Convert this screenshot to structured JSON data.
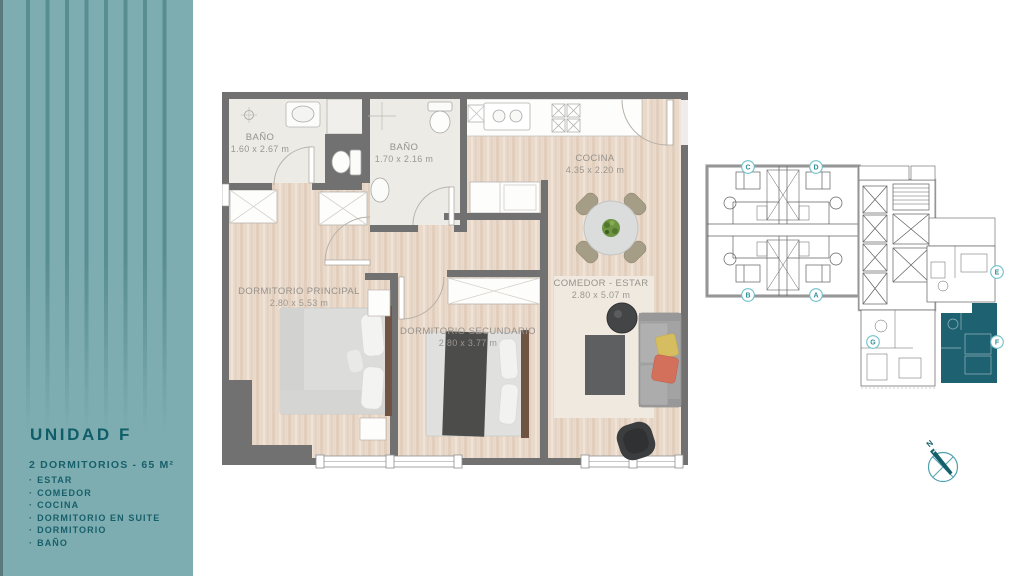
{
  "sidebar": {
    "title": "UNIDAD F",
    "subtitle": "2 DORMITORIOS - 65 M²",
    "bullet": "·",
    "features": [
      "ESTAR",
      "COMEDOR",
      "COCINA",
      "DORMITORIO EN SUITE",
      "DORMITORIO",
      "BAÑO"
    ]
  },
  "floorplan": {
    "rooms": {
      "bano1": {
        "name": "BAÑO",
        "dims": "1.60 x 2.67 m"
      },
      "bano2": {
        "name": "BAÑO",
        "dims": "1.70 x 2.16 m"
      },
      "cocina": {
        "name": "COCINA",
        "dims": "4.35 x 2.20 m"
      },
      "comedor_estar": {
        "name": "COMEDOR - ESTAR",
        "dims": "2.80 x 5.07 m"
      },
      "dormitorio_principal": {
        "name": "DORMITORIO PRINCIPAL",
        "dims": "2.80 x 5.53 m"
      },
      "dormitorio_secundario": {
        "name": "DORMITORIO SECUNDARIO",
        "dims": "2.80 x 3.77 m"
      }
    }
  },
  "keyplan": {
    "units": {
      "c": "C",
      "d": "D",
      "b": "B",
      "a": "A",
      "e": "E",
      "g": "G",
      "f": "F"
    },
    "highlighted_unit": "F"
  },
  "compass": {
    "north": "N"
  },
  "colors": {
    "sidebar_teal": "#7dadb0",
    "dark_teal": "#0f5d69",
    "wall_gray": "#717171",
    "wood_floor": "#e9d9ca",
    "unit_highlight": "#1e6170",
    "keyplan_circle": "#6fc0ca"
  }
}
